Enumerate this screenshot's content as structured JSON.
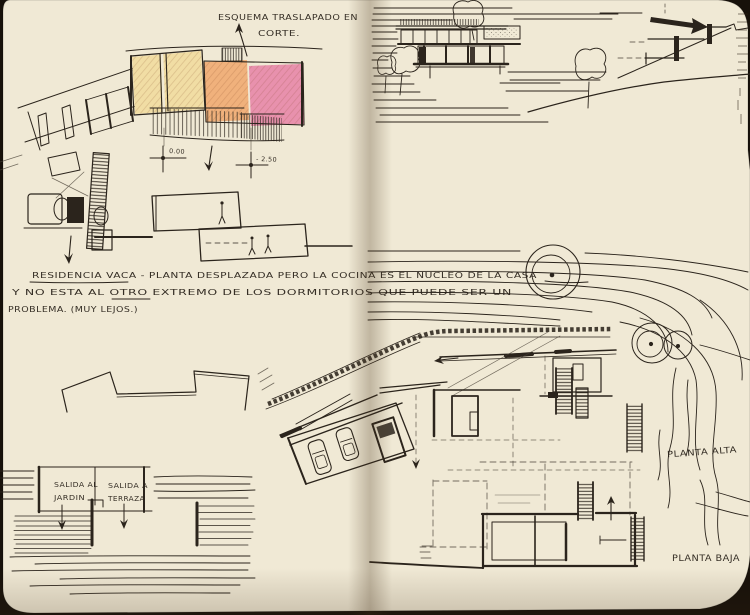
{
  "sketchbook": {
    "esquema_note": {
      "line1": "ESQUEMA TRASLAPADO EN",
      "line2": "CORTE."
    },
    "levels": {
      "upper": "0.00",
      "lower": "- 2.50"
    },
    "residencia_note": {
      "line1": "RESIDENCIA VACA - PLANTA DESPLAZADA PERO LA COCINA ES EL NUCLEO DE LA CASA",
      "line2": "Y NO ESTA AL OTRO EXTREMO DE LOS DORMITORIOS QUE PUEDE SER UN",
      "line3": "PROBLEMA. (MUY LEJOS.)"
    },
    "terrace_plan": {
      "room1_line1": "SALIDA AL",
      "room1_line2": "JARDIN",
      "room2_line1": "SALIDA A",
      "room2_line2": "TERRAZA"
    },
    "plan_labels": {
      "upper": "PLANTA ALTA",
      "lower": "PLANTA BAJA"
    },
    "colors": {
      "paper": "#f0e9d5",
      "ink": "#2b241c",
      "pencil_yellow": "#f1dda4",
      "pencil_orange": "#f0b17c",
      "pencil_pink": "#e891ad",
      "cover": "#17110a"
    }
  }
}
